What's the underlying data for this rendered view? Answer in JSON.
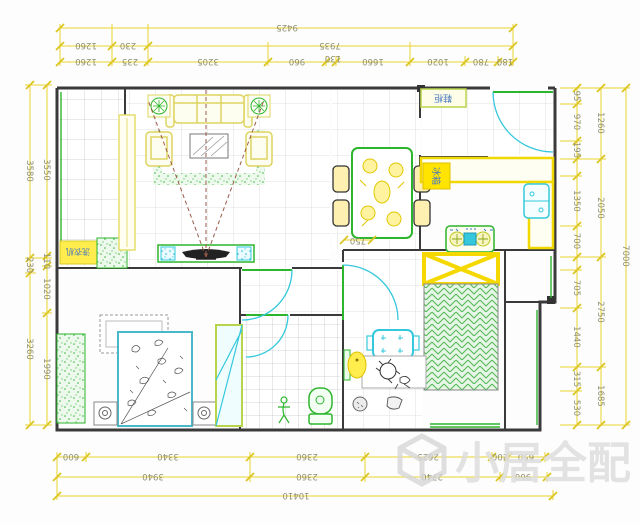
{
  "dims": {
    "top": {
      "total": "9425",
      "row2": [
        "1260",
        "230",
        "7935"
      ],
      "row1": [
        "1260",
        "235",
        "3205",
        "960",
        "130",
        "1660",
        "1020",
        "780",
        "180"
      ]
    },
    "bottom": {
      "total": "10410",
      "row2": [
        "3940",
        "2360",
        "2740",
        "960"
      ],
      "row1": [
        "600",
        "3340",
        "2360",
        "2625",
        "200",
        "650"
      ]
    },
    "left": {
      "outer": [
        "3580",
        "230",
        "3260"
      ],
      "inner": [
        "3550",
        "110",
        "1020",
        "1990"
      ]
    },
    "right": {
      "total": "7000",
      "mid": [
        "1260",
        "2050",
        "2750",
        "1685"
      ],
      "inner": [
        "95",
        "970",
        "195",
        "1350",
        "700",
        "705",
        "1440",
        "315",
        "530"
      ]
    },
    "dining_table_width": "750"
  },
  "labels": {
    "washing_machine": "洗衣机",
    "shoe_cabinet": "鞋柜",
    "fridge": "冰箱"
  },
  "watermark": {
    "text": "小居全配"
  },
  "colors": {
    "dimension_line": "#e8d22e",
    "dimension_text": "#8f8f72",
    "wall": "#3a3a3a",
    "furniture_green": "#2db52d",
    "appliance_cyan": "#35c8dc",
    "highlight_yellow": "#f5d800",
    "label_blue": "#4878c0"
  }
}
